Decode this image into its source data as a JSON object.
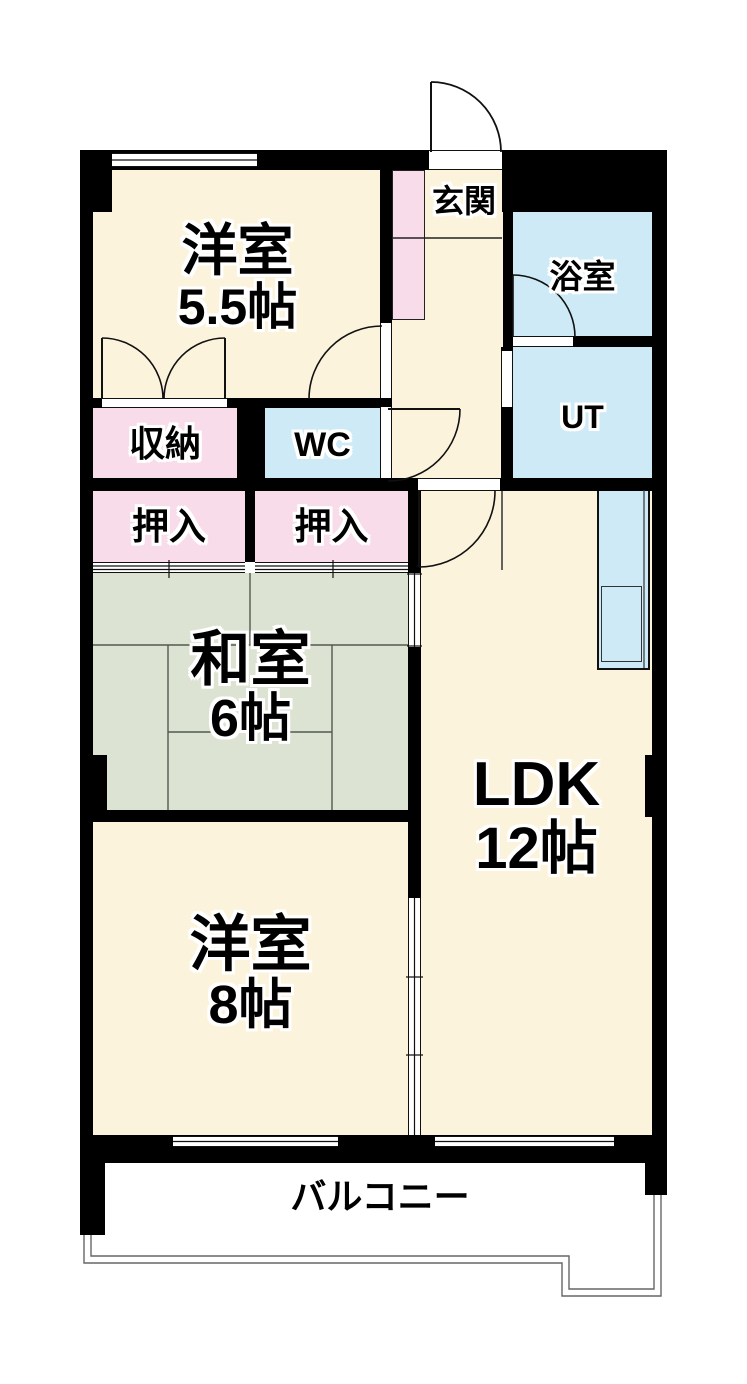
{
  "rooms": {
    "western_room_small": {
      "label": "洋室",
      "size": "5.5帖"
    },
    "entrance": {
      "label": "玄関"
    },
    "bathroom": {
      "label": "浴室"
    },
    "utility": {
      "label": "UT"
    },
    "toilet": {
      "label": "WC"
    },
    "storage": {
      "label": "収納"
    },
    "closet_left": {
      "label": "押入"
    },
    "closet_right": {
      "label": "押入"
    },
    "japanese_room": {
      "label": "和室",
      "size": "6帖"
    },
    "ldk": {
      "label": "LDK",
      "size": "12帖"
    },
    "western_room_large": {
      "label": "洋室",
      "size": "8帖"
    },
    "balcony": {
      "label": "バルコニー"
    }
  },
  "colors": {
    "wall": "#000000",
    "western_room": "#fcf3dd",
    "japanese_room": "#dde3d2",
    "wet_area": "#cdeaf6",
    "closet": "#f9dce9",
    "background": "#ffffff"
  }
}
